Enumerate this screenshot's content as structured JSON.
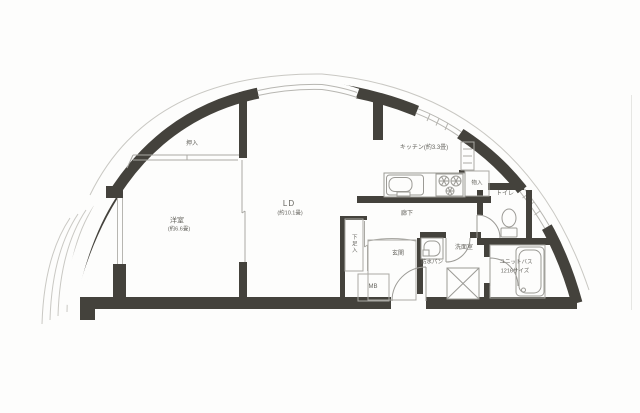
{
  "labels": {
    "bedroom_name": "洋室",
    "bedroom_size": "(約6.6畳)",
    "living_name": "LD",
    "living_size": "(約10.1畳)",
    "kitchen_name": "キッチン(約3.3畳)",
    "closet_oshiire": "押入",
    "closet_monoire": "物入",
    "toilet": "トイレ",
    "washroom": "洗面室",
    "laundry_pan": "防水パン",
    "bath_name": "ユニットバス",
    "bath_size": "1216サイズ",
    "hallway": "廊下",
    "entrance": "玄関",
    "shoe_closet": "下足入",
    "meter_box": "MB"
  },
  "colors": {
    "wall": "#44423c",
    "fixture_line": "#9b9a95",
    "thin_line": "#aaa9a4",
    "railing": "#c9c8c3",
    "text": "#66655f",
    "background": "#fdfdfc"
  }
}
